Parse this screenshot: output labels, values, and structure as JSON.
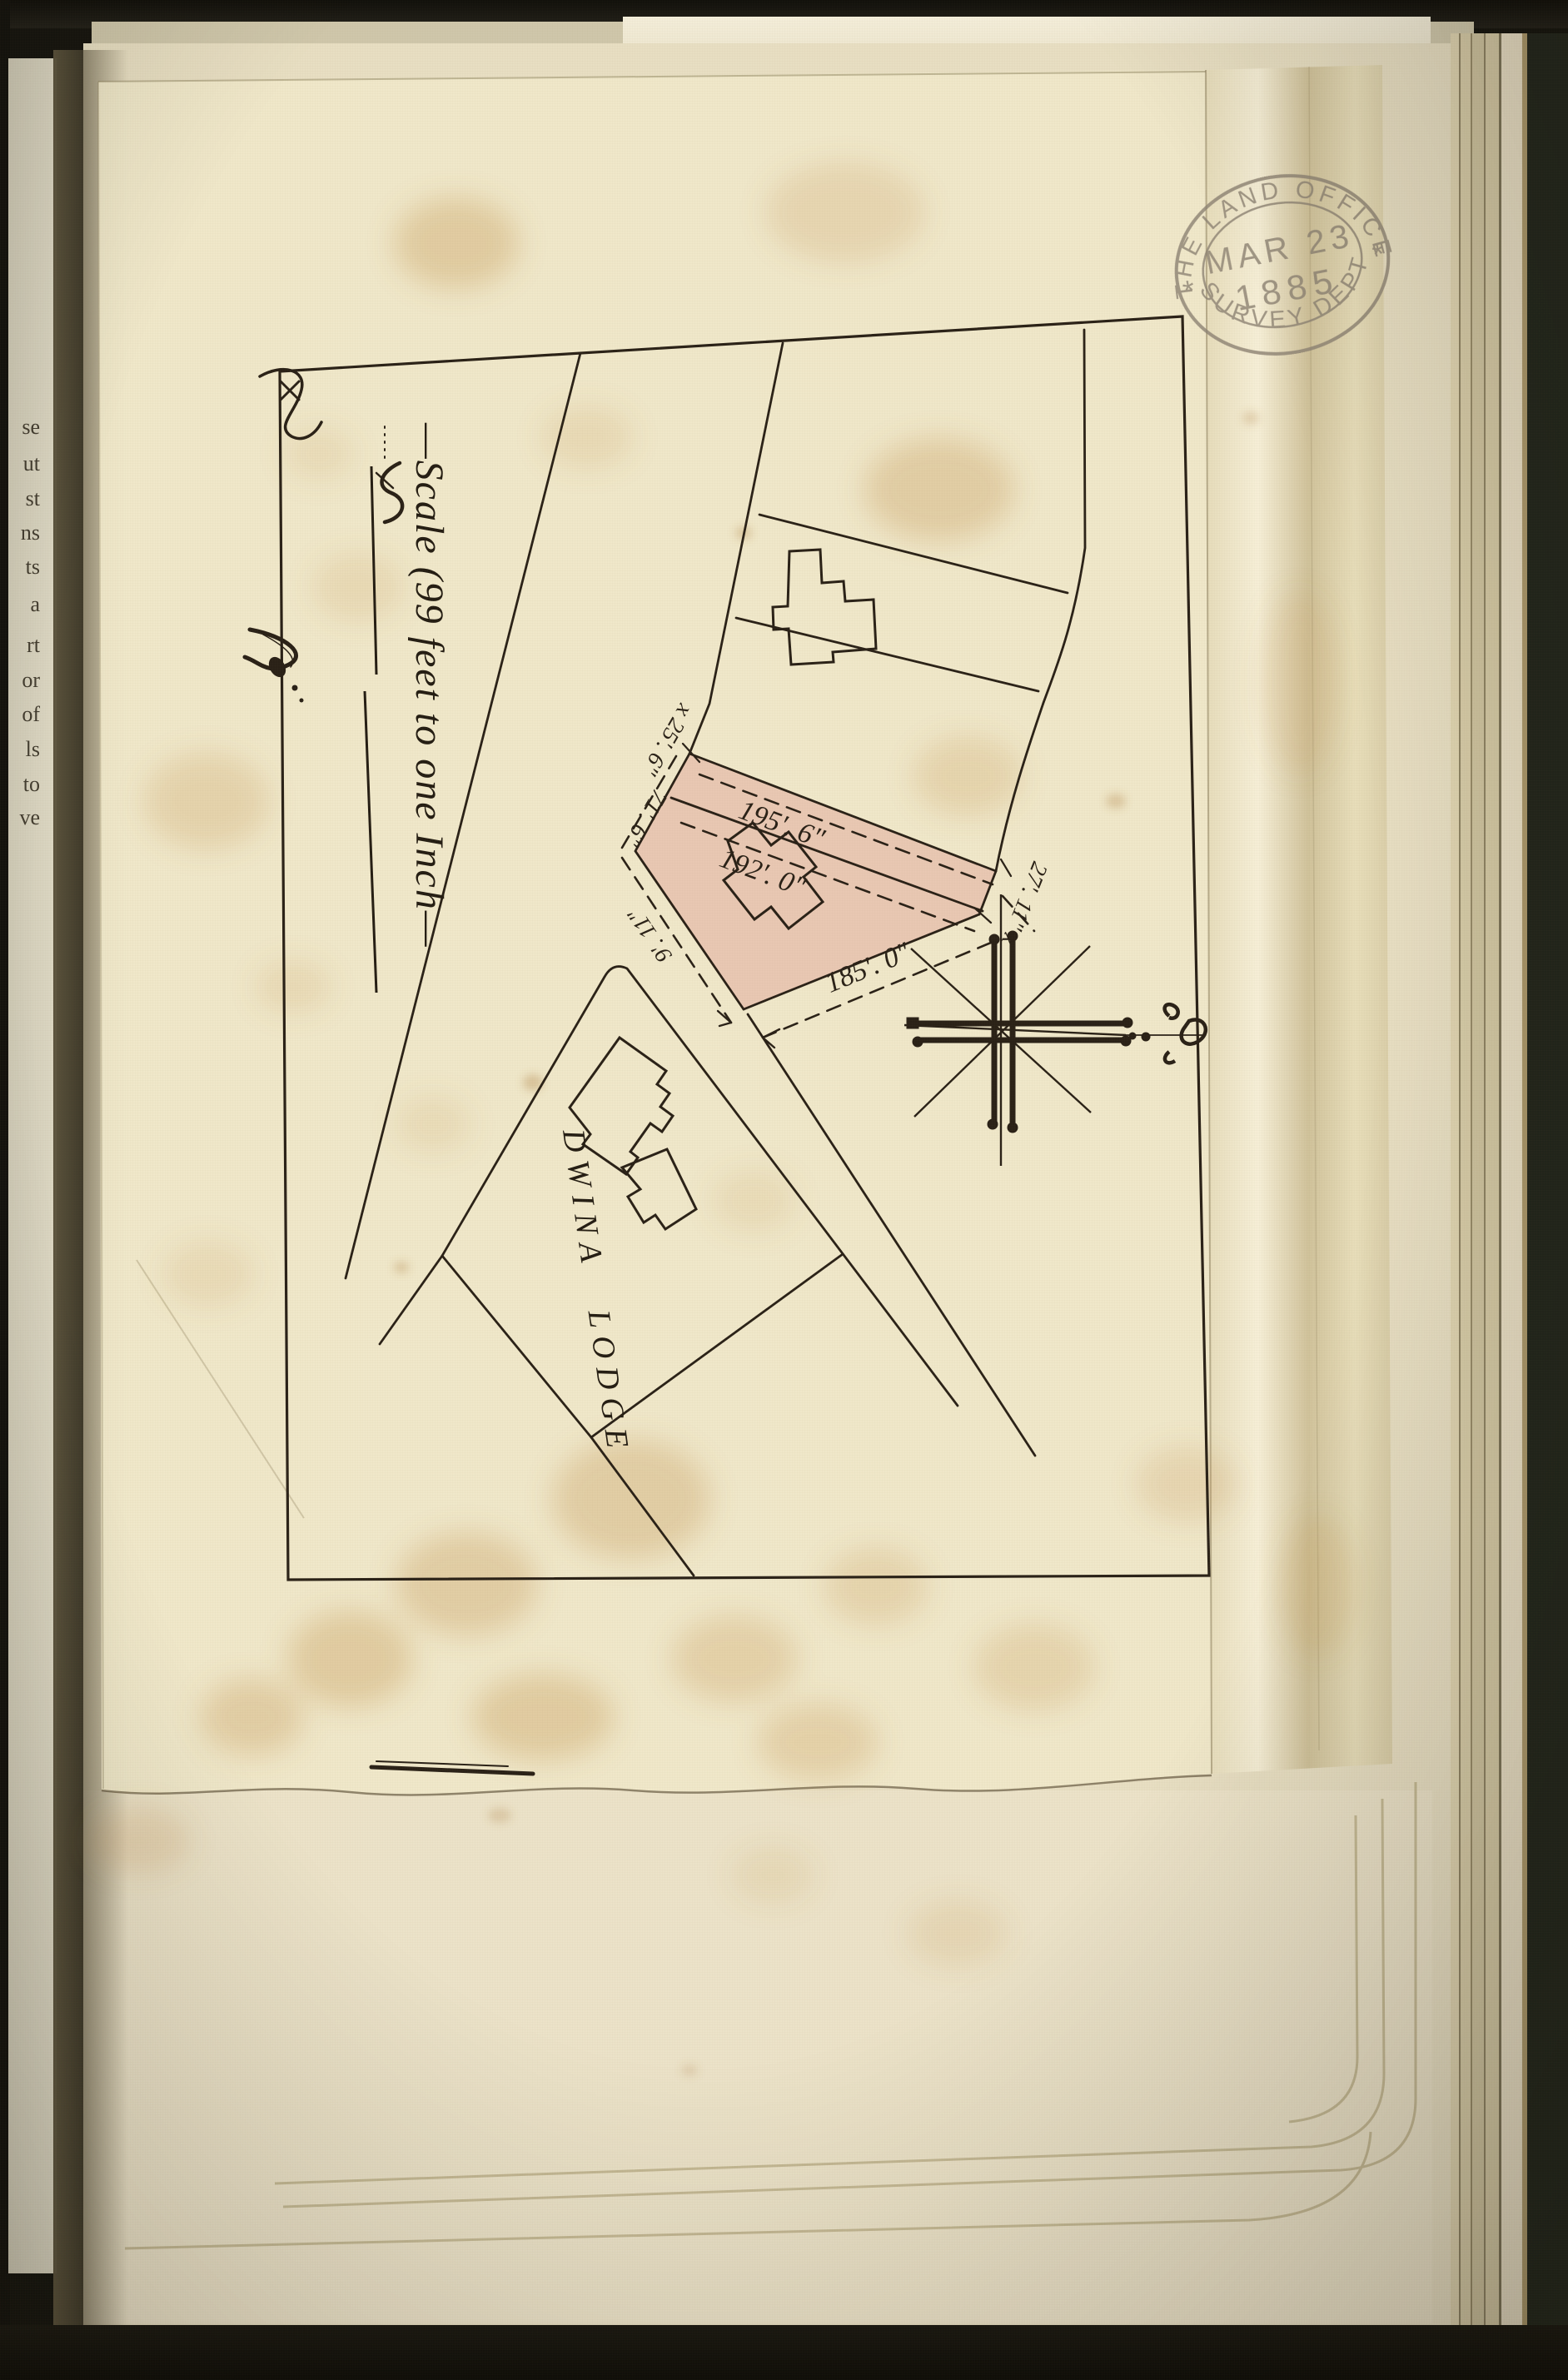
{
  "page": {
    "stamp": {
      "arc_top": "THE LAND OFFICE",
      "date_month_day": "MAR 23",
      "date_year": "1885",
      "arc_bottom": "SURVEY DEPT",
      "star": "*"
    },
    "scale_note": "—Scale (99 feet to one Inch—",
    "map": {
      "estate_label": "DWINA LODGE",
      "dimensions": {
        "front_upper": "195'. 6\"",
        "front_lower": "192'. 0\"",
        "southeast": "185'. 0\"",
        "northeast_corner": "27'. 11\" x",
        "northwest_upper": "x 25'. 6\"",
        "northwest_lower": "71'. 6\"",
        "southwest": "9'. 11\""
      }
    },
    "left_margin_fragments": [
      "se",
      "ut",
      "st",
      "ns",
      "ts",
      "a",
      "rt",
      "or",
      "of",
      "ls",
      "to",
      "ve"
    ],
    "colors": {
      "ink": "#2a2117",
      "page": "#e8dfc3",
      "tracing_paper": "#f0e8ca",
      "parcel_pink": "#e2a79c",
      "stain": "#c4934f",
      "stamp_ink": "#8d8273",
      "background": "#16150f"
    }
  }
}
